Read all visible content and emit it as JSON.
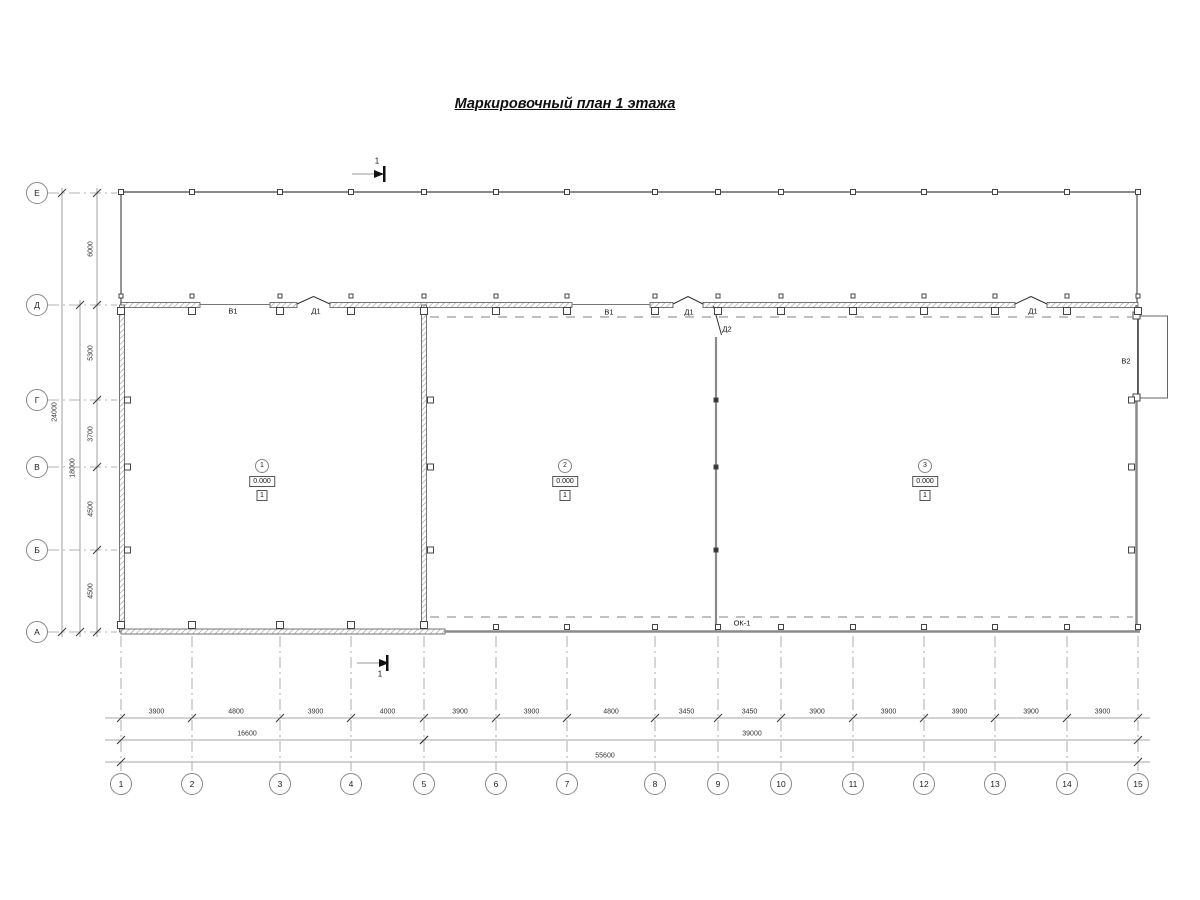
{
  "title": "Маркировочный план 1 этажа",
  "section": {
    "label": "1"
  },
  "grid": {
    "rows": [
      {
        "label": "Е",
        "y": 193
      },
      {
        "label": "Д",
        "y": 305
      },
      {
        "label": "Г",
        "y": 400
      },
      {
        "label": "В",
        "y": 467
      },
      {
        "label": "Б",
        "y": 550
      },
      {
        "label": "А",
        "y": 632
      }
    ],
    "cols": [
      {
        "label": "1",
        "x": 121
      },
      {
        "label": "2",
        "x": 192
      },
      {
        "label": "3",
        "x": 280
      },
      {
        "label": "4",
        "x": 351
      },
      {
        "label": "5",
        "x": 424
      },
      {
        "label": "6",
        "x": 496
      },
      {
        "label": "7",
        "x": 567
      },
      {
        "label": "8",
        "x": 655
      },
      {
        "label": "9",
        "x": 718
      },
      {
        "label": "10",
        "x": 781
      },
      {
        "label": "11",
        "x": 853
      },
      {
        "label": "12",
        "x": 924
      },
      {
        "label": "13",
        "x": 995
      },
      {
        "label": "14",
        "x": 1067
      },
      {
        "label": "15",
        "x": 1138
      }
    ]
  },
  "dims": {
    "bottom": {
      "segments": [
        "3900",
        "4800",
        "3900",
        "4000",
        "3900",
        "3900",
        "4800",
        "3450",
        "3450",
        "3900",
        "3900",
        "3900",
        "3900",
        "3900"
      ],
      "subtotals": [
        {
          "value": "16600",
          "cx": 247,
          "tick_cols": [
            0,
            4
          ]
        },
        {
          "value": "39000",
          "cx": 752,
          "tick_cols": [
            4,
            14
          ]
        }
      ],
      "total": {
        "value": "55600",
        "cx": 605,
        "tick_cols": [
          0,
          14
        ]
      }
    },
    "left": {
      "segments": [
        "6000",
        "5300",
        "3700",
        "4500",
        "4500"
      ],
      "subtotal": {
        "value": "18000",
        "tick_rows": [
          1,
          5
        ]
      },
      "total": {
        "value": "24000",
        "tick_rows": [
          0,
          5
        ]
      }
    }
  },
  "rooms": [
    {
      "number": "1",
      "elevation": "0.000",
      "floor_type": "1",
      "cx": 262
    },
    {
      "number": "2",
      "elevation": "0.000",
      "floor_type": "1",
      "cx": 565
    },
    {
      "number": "3",
      "elevation": "0.000",
      "floor_type": "1",
      "cx": 925
    }
  ],
  "openings": {
    "v1_a": {
      "label": "В1",
      "x": 233,
      "y": 311
    },
    "d1_a": {
      "label": "Д1",
      "x": 316,
      "y": 311
    },
    "v1_b": {
      "label": "В1",
      "x": 609,
      "y": 312
    },
    "d1_b": {
      "label": "Д1",
      "x": 689,
      "y": 312
    },
    "d2": {
      "label": "Д2",
      "x": 727,
      "y": 329
    },
    "d1_c": {
      "label": "Д1",
      "x": 1033,
      "y": 311
    },
    "v2": {
      "label": "В2",
      "x": 1126,
      "y": 361
    },
    "ok1": {
      "label": "ОК-1",
      "x": 742,
      "y": 623
    }
  },
  "colors": {
    "wall": "#8a8a8a",
    "hatch": "#9a9a9a",
    "thin_line": "#888888",
    "dash_line": "#9a9a9a",
    "text": "#111111"
  }
}
